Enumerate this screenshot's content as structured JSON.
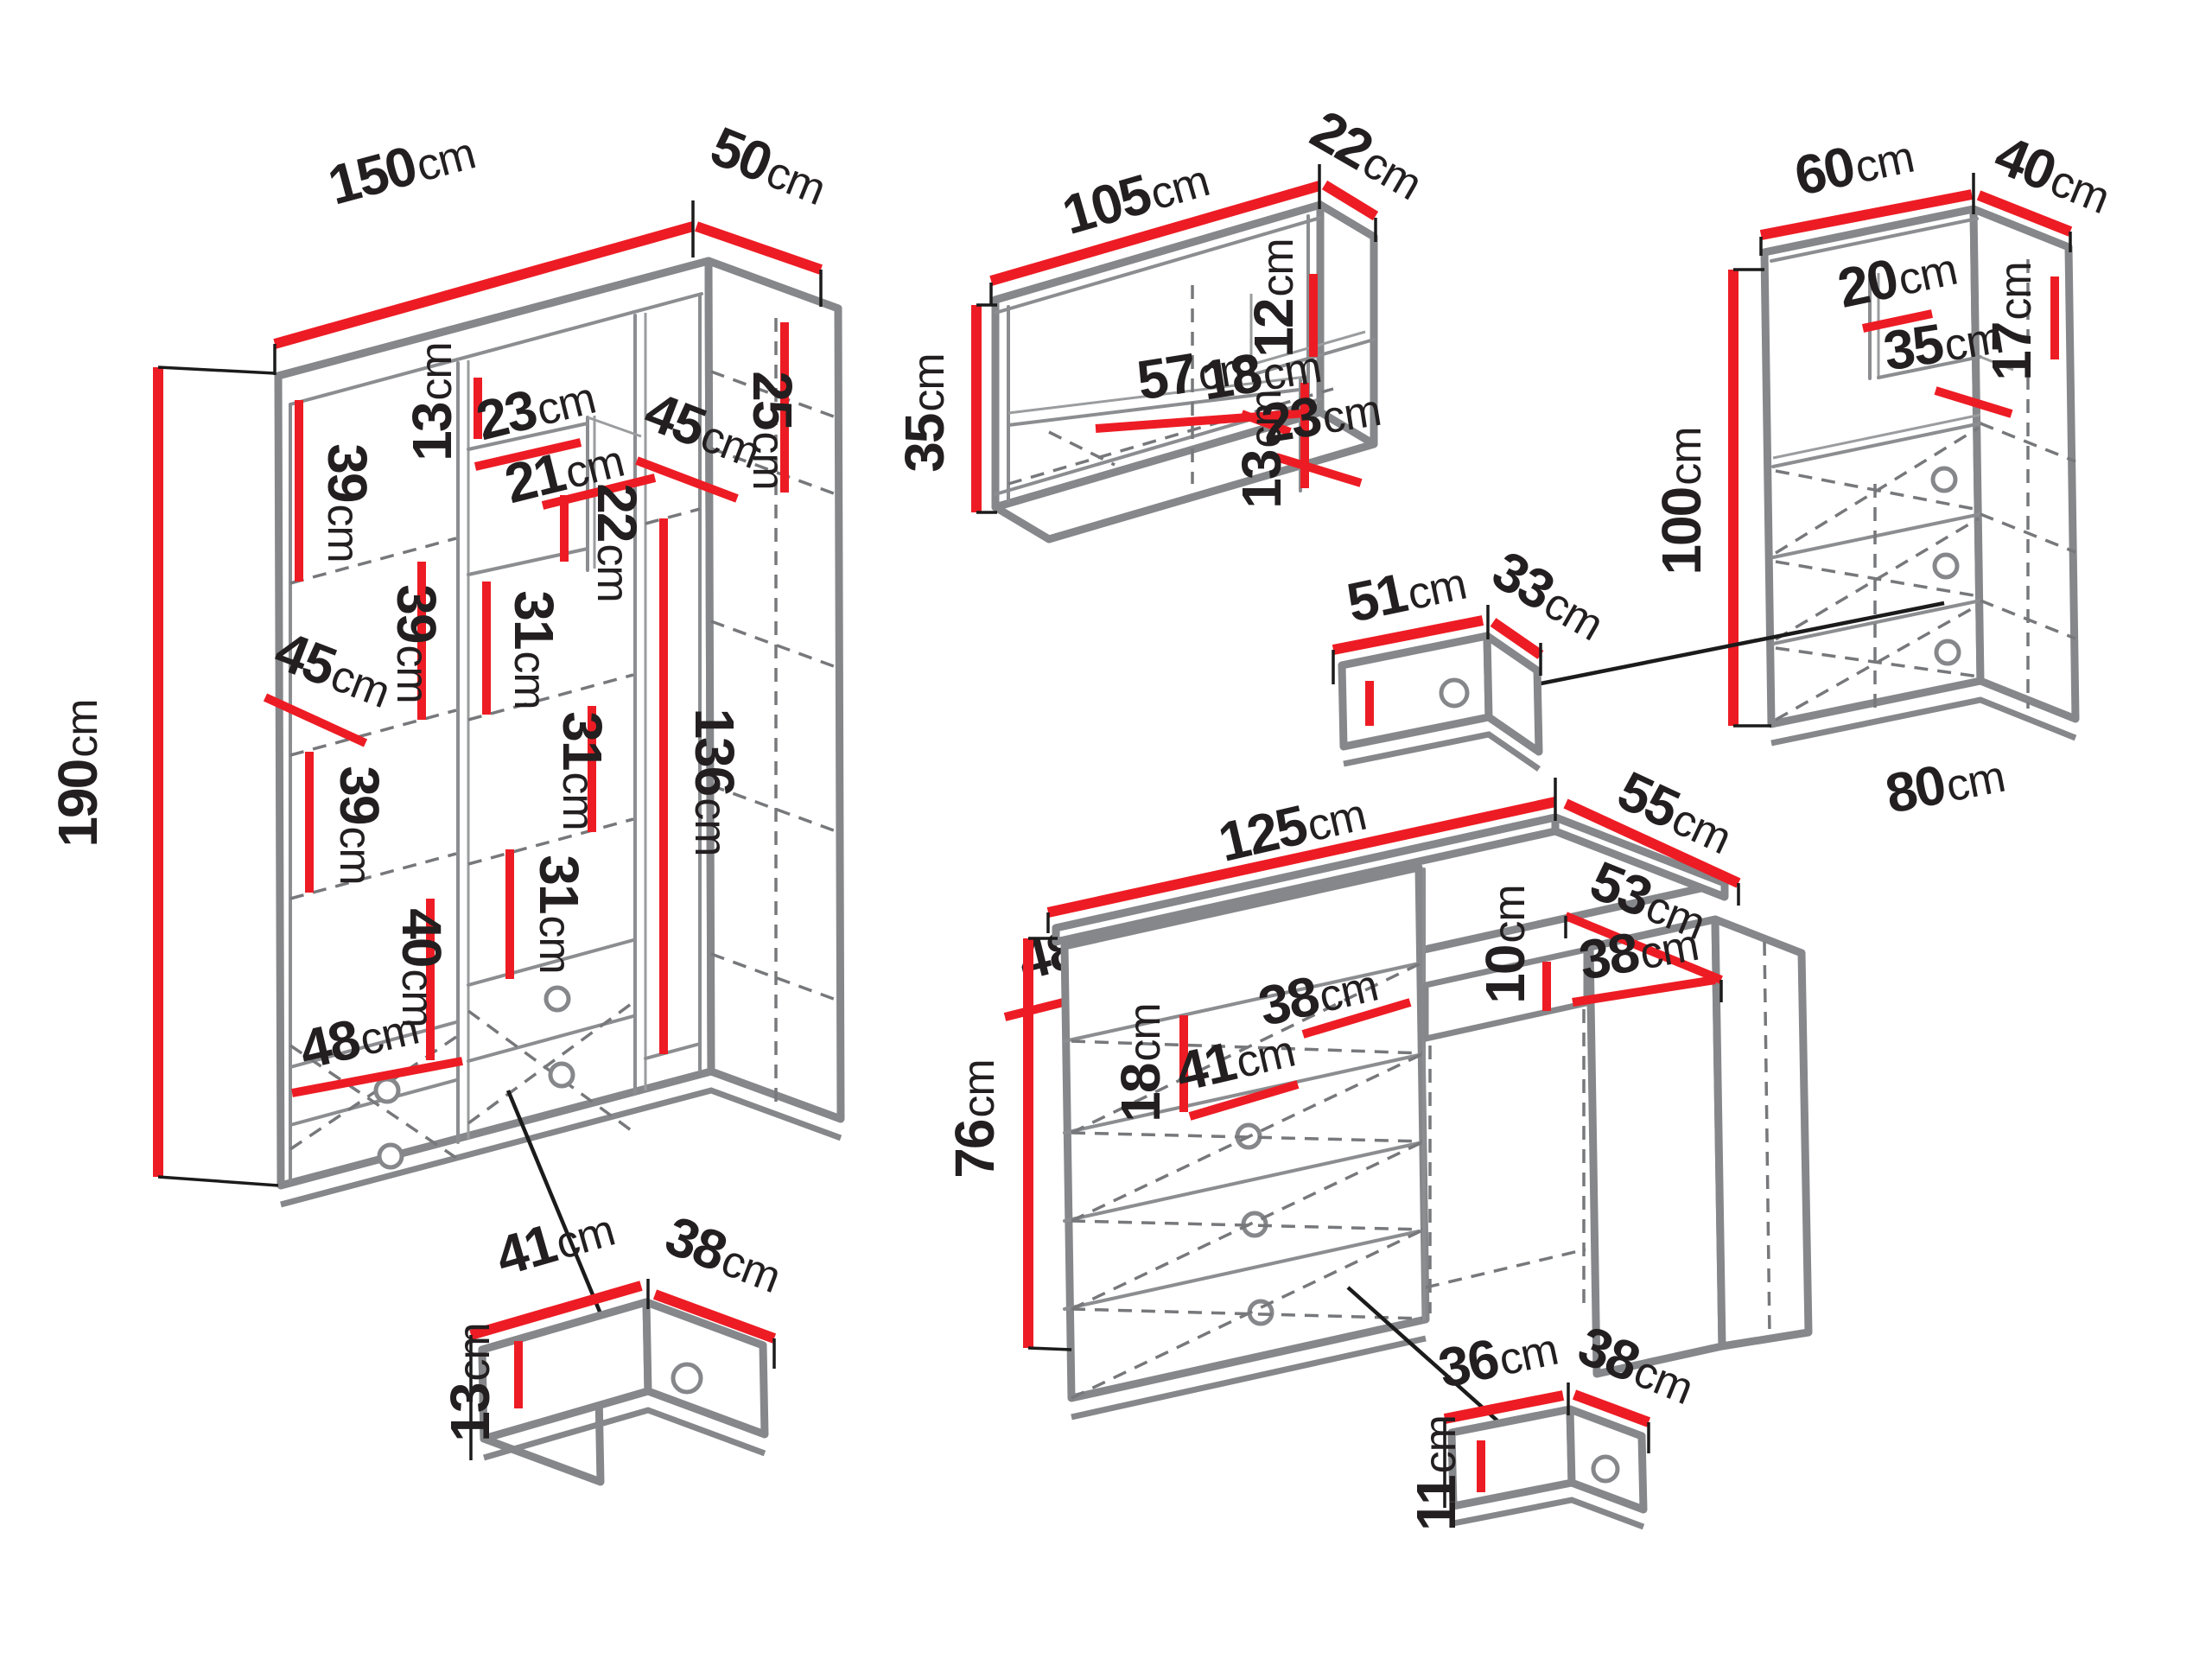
{
  "diagram": "furniture-set-dimension-drawing",
  "unit": "cm",
  "colors": {
    "dimension_line": "#ed1c24",
    "outline": "#85878a",
    "label_text": "#231f20"
  },
  "wardrobe": {
    "width": {
      "value": "150",
      "unit": "cm"
    },
    "depth": {
      "value": "50",
      "unit": "cm"
    },
    "height": {
      "value": "190",
      "unit": "cm"
    },
    "interior": {
      "shelf_top": {
        "value": "39",
        "unit": "cm"
      },
      "top_shelf_h": {
        "value": "13",
        "unit": "cm"
      },
      "niche_w_top": {
        "value": "23",
        "unit": "cm"
      },
      "niche_w_bottom": {
        "value": "21",
        "unit": "cm"
      },
      "depth_right": {
        "value": "45",
        "unit": "cm"
      },
      "right_top_h": {
        "value": "25",
        "unit": "cm"
      },
      "niche_h": {
        "value": "22",
        "unit": "cm"
      },
      "shelf_mid": {
        "value": "39",
        "unit": "cm"
      },
      "col_gap_a": {
        "value": "31",
        "unit": "cm"
      },
      "depth_left": {
        "value": "45",
        "unit": "cm"
      },
      "col_gap_b": {
        "value": "31",
        "unit": "cm"
      },
      "shelf_low": {
        "value": "39",
        "unit": "cm"
      },
      "right_col_h": {
        "value": "136",
        "unit": "cm"
      },
      "col_gap_c": {
        "value": "31",
        "unit": "cm"
      },
      "lower_left_h": {
        "value": "40",
        "unit": "cm"
      },
      "bottom_w_left": {
        "value": "48",
        "unit": "cm"
      },
      "bottom_w_right": {
        "value": "48",
        "unit": "cm"
      }
    },
    "drawer": {
      "width": {
        "value": "41",
        "unit": "cm"
      },
      "depth": {
        "value": "38",
        "unit": "cm"
      },
      "height": {
        "value": "13",
        "unit": "cm"
      }
    }
  },
  "wall_shelf": {
    "width": {
      "value": "105",
      "unit": "cm"
    },
    "depth": {
      "value": "22",
      "unit": "cm"
    },
    "height": {
      "value": "35",
      "unit": "cm"
    },
    "interior": {
      "span_w": {
        "value": "57",
        "unit": "cm"
      },
      "mid_h": {
        "value": "13",
        "unit": "cm"
      },
      "niche_w": {
        "value": "18",
        "unit": "cm"
      },
      "niche_h": {
        "value": "12",
        "unit": "cm"
      },
      "right_w": {
        "value": "23",
        "unit": "cm"
      }
    }
  },
  "chest": {
    "width": {
      "value": "60",
      "unit": "cm"
    },
    "depth": {
      "value": "40",
      "unit": "cm"
    },
    "height": {
      "value": "100",
      "unit": "cm"
    },
    "base_width": {
      "value": "80",
      "unit": "cm"
    },
    "interior": {
      "niche_w": {
        "value": "20",
        "unit": "cm"
      },
      "niche_d": {
        "value": "35",
        "unit": "cm"
      },
      "niche_h": {
        "value": "17",
        "unit": "cm"
      }
    },
    "drawer": {
      "width": {
        "value": "51",
        "unit": "cm"
      },
      "depth": {
        "value": "33",
        "unit": "cm"
      }
    }
  },
  "desk": {
    "width": {
      "value": "125",
      "unit": "cm"
    },
    "depth": {
      "value": "55",
      "unit": "cm"
    },
    "height": {
      "value": "76",
      "unit": "cm"
    },
    "interior": {
      "surface_d": {
        "value": "53",
        "unit": "cm"
      },
      "surface_w": {
        "value": "38",
        "unit": "cm"
      },
      "apron_h": {
        "value": "10",
        "unit": "cm"
      },
      "kneehole_w": {
        "value": "38",
        "unit": "cm"
      },
      "pedestal_w": {
        "value": "41",
        "unit": "cm"
      },
      "top_drawer_h": {
        "value": "18",
        "unit": "cm"
      }
    },
    "drawer": {
      "width": {
        "value": "36",
        "unit": "cm"
      },
      "depth": {
        "value": "38",
        "unit": "cm"
      },
      "height": {
        "value": "11",
        "unit": "cm"
      }
    }
  }
}
